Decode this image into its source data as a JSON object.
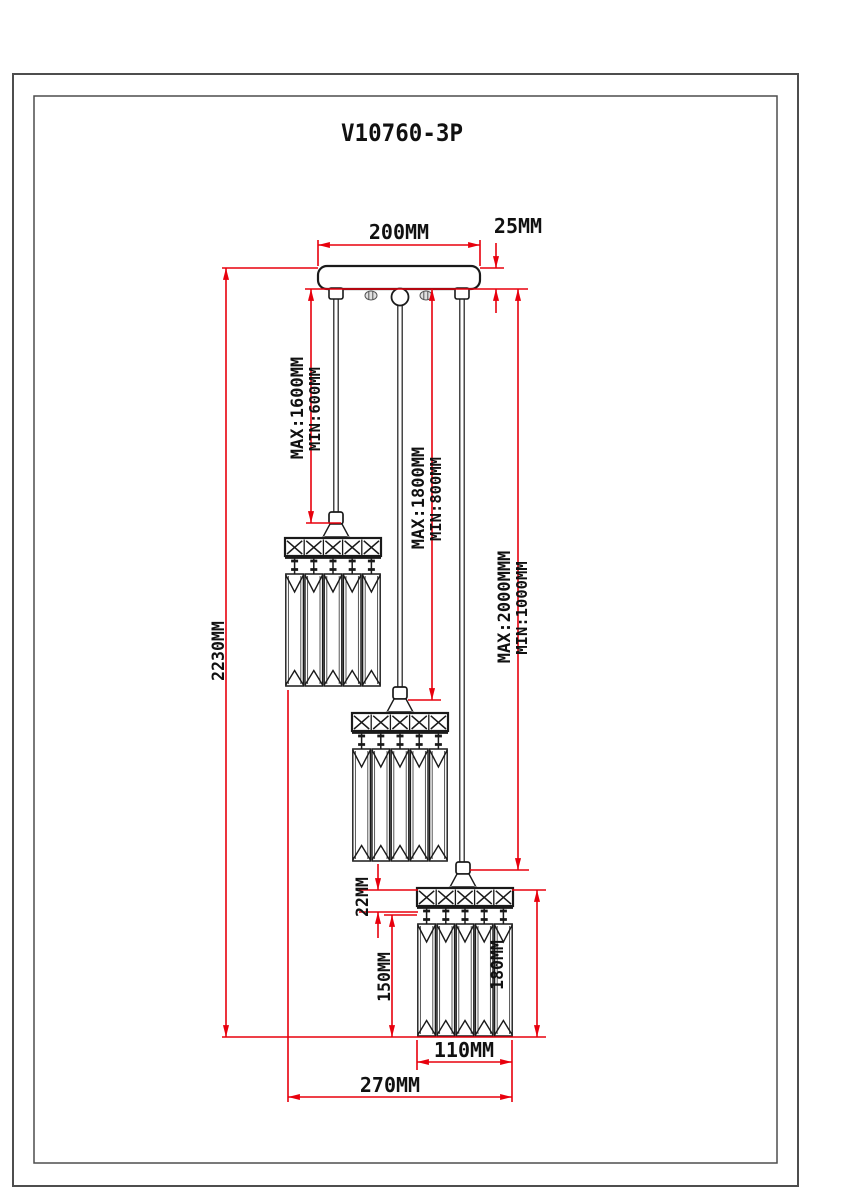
{
  "title": "V10760-3P",
  "dims": {
    "canopy_width": "200MM",
    "canopy_height": "25MM",
    "overall_height": "2230MM",
    "cord1": {
      "max": "MAX:1600MM",
      "min": "MIN:600MM"
    },
    "cord2": {
      "max": "MAX:1800MM",
      "min": "MIN:800MM"
    },
    "cord3": {
      "max": "MAX:2000MMM",
      "min": "MIN:1000MM"
    },
    "shade_band_height": "22MM",
    "shade_crystal_height": "150MM",
    "shade_total_height": "180MM",
    "shade_width": "110MM",
    "overall_width": "270MM"
  },
  "colors": {
    "dimension_red": "#e8000d",
    "drawing_black": "#1a1a1a",
    "border_gray": "#4d4d4d"
  }
}
